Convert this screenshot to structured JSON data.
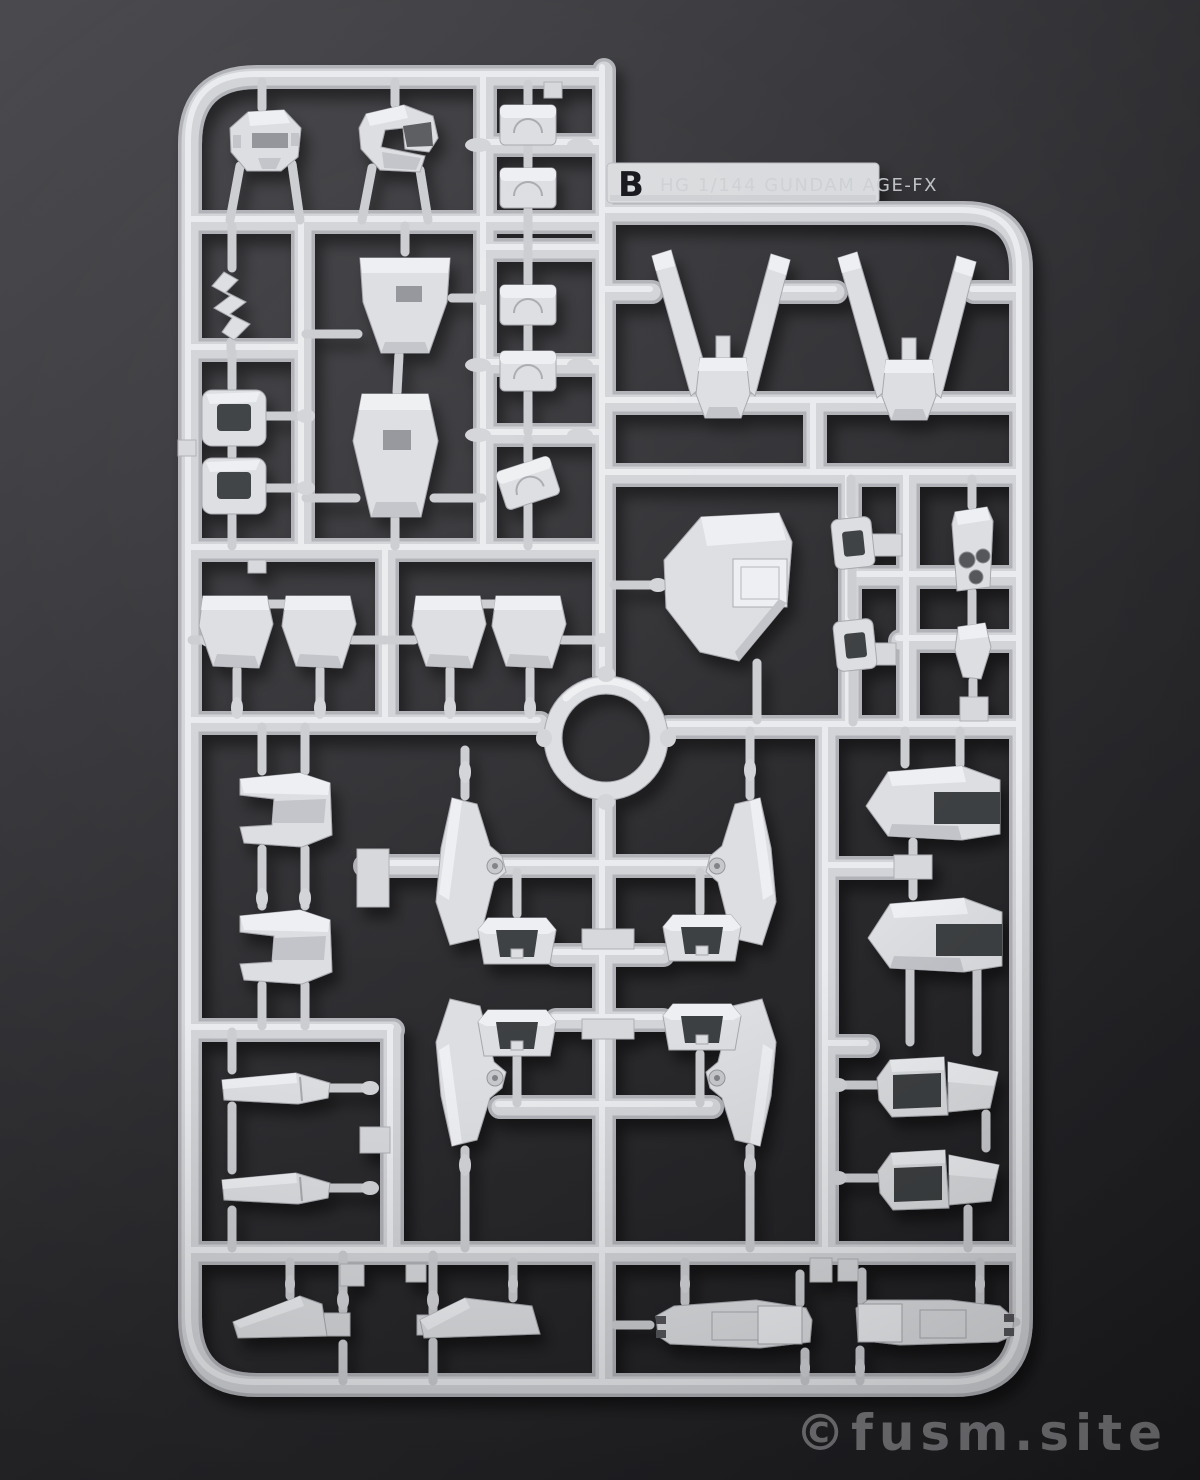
{
  "scene": {
    "description": "Photograph of a light-gray injection-molded Gunpla parts runner (sprue) laid on a dark studio background",
    "type": "photo"
  },
  "runner": {
    "tab_letter": "B",
    "tab_embossed_text": "HG 1/144 GUNDAM AGE-FX",
    "plastic_color": "#d6d8db",
    "plastic_highlight": "#eceef0",
    "plastic_shadow": "#b0b2b7"
  },
  "watermark": {
    "text": "©fusm.site",
    "color": "#7f7f83"
  },
  "background": {
    "gradient_top_left": "#4b4b4f",
    "gradient_bottom": "#1c1c1f"
  },
  "colors": {
    "tab_letter_color": "#17171a"
  }
}
